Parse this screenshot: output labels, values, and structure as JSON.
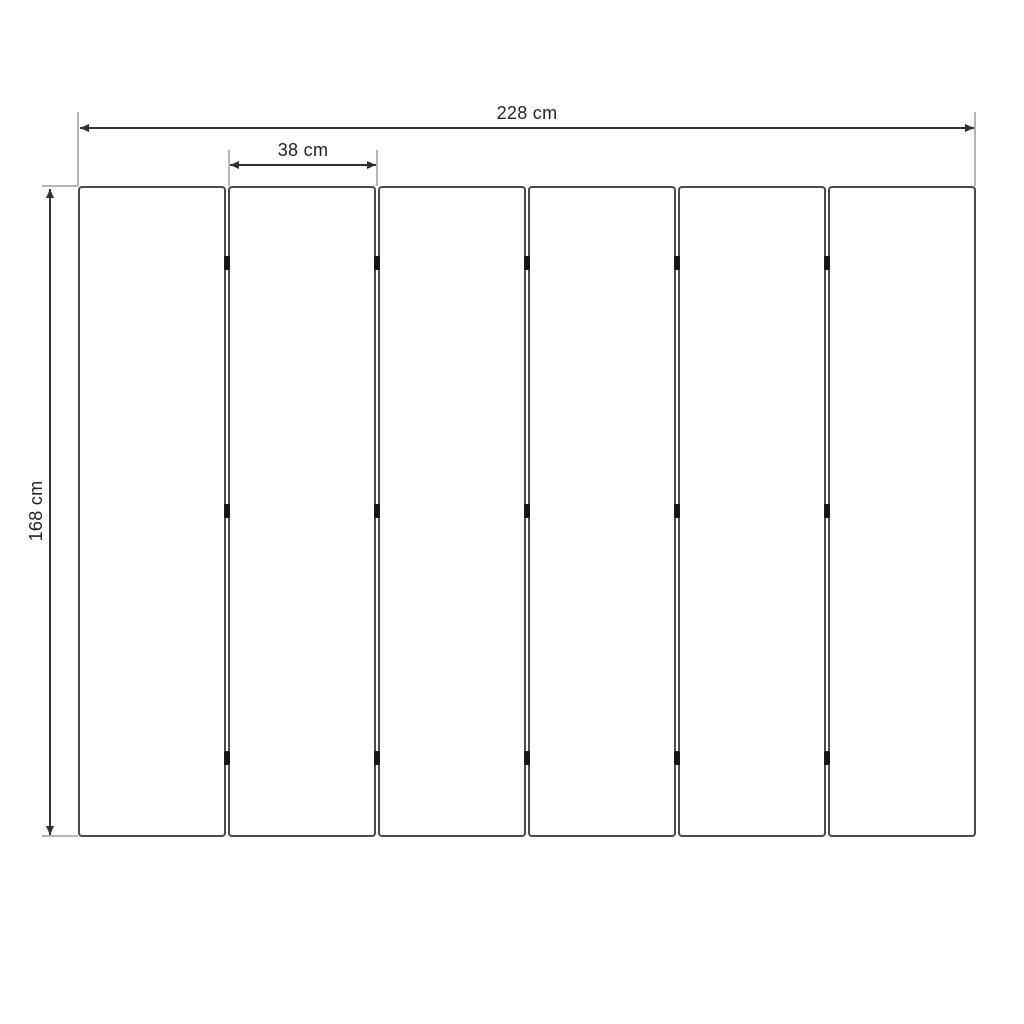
{
  "diagram": {
    "kind": "dimension-drawing",
    "dimensions": {
      "total_width": "228 cm",
      "panel_width": "38 cm",
      "height": "168 cm"
    },
    "panel_count": 6,
    "hinge_rows": 3,
    "hinge_columns": 5,
    "colors": {
      "background": "#ffffff",
      "dimension": "#303030",
      "extension": "#b5b5b5",
      "panel_border": "#4a4a4a",
      "hinge": "#161616",
      "text": "#222222"
    }
  }
}
